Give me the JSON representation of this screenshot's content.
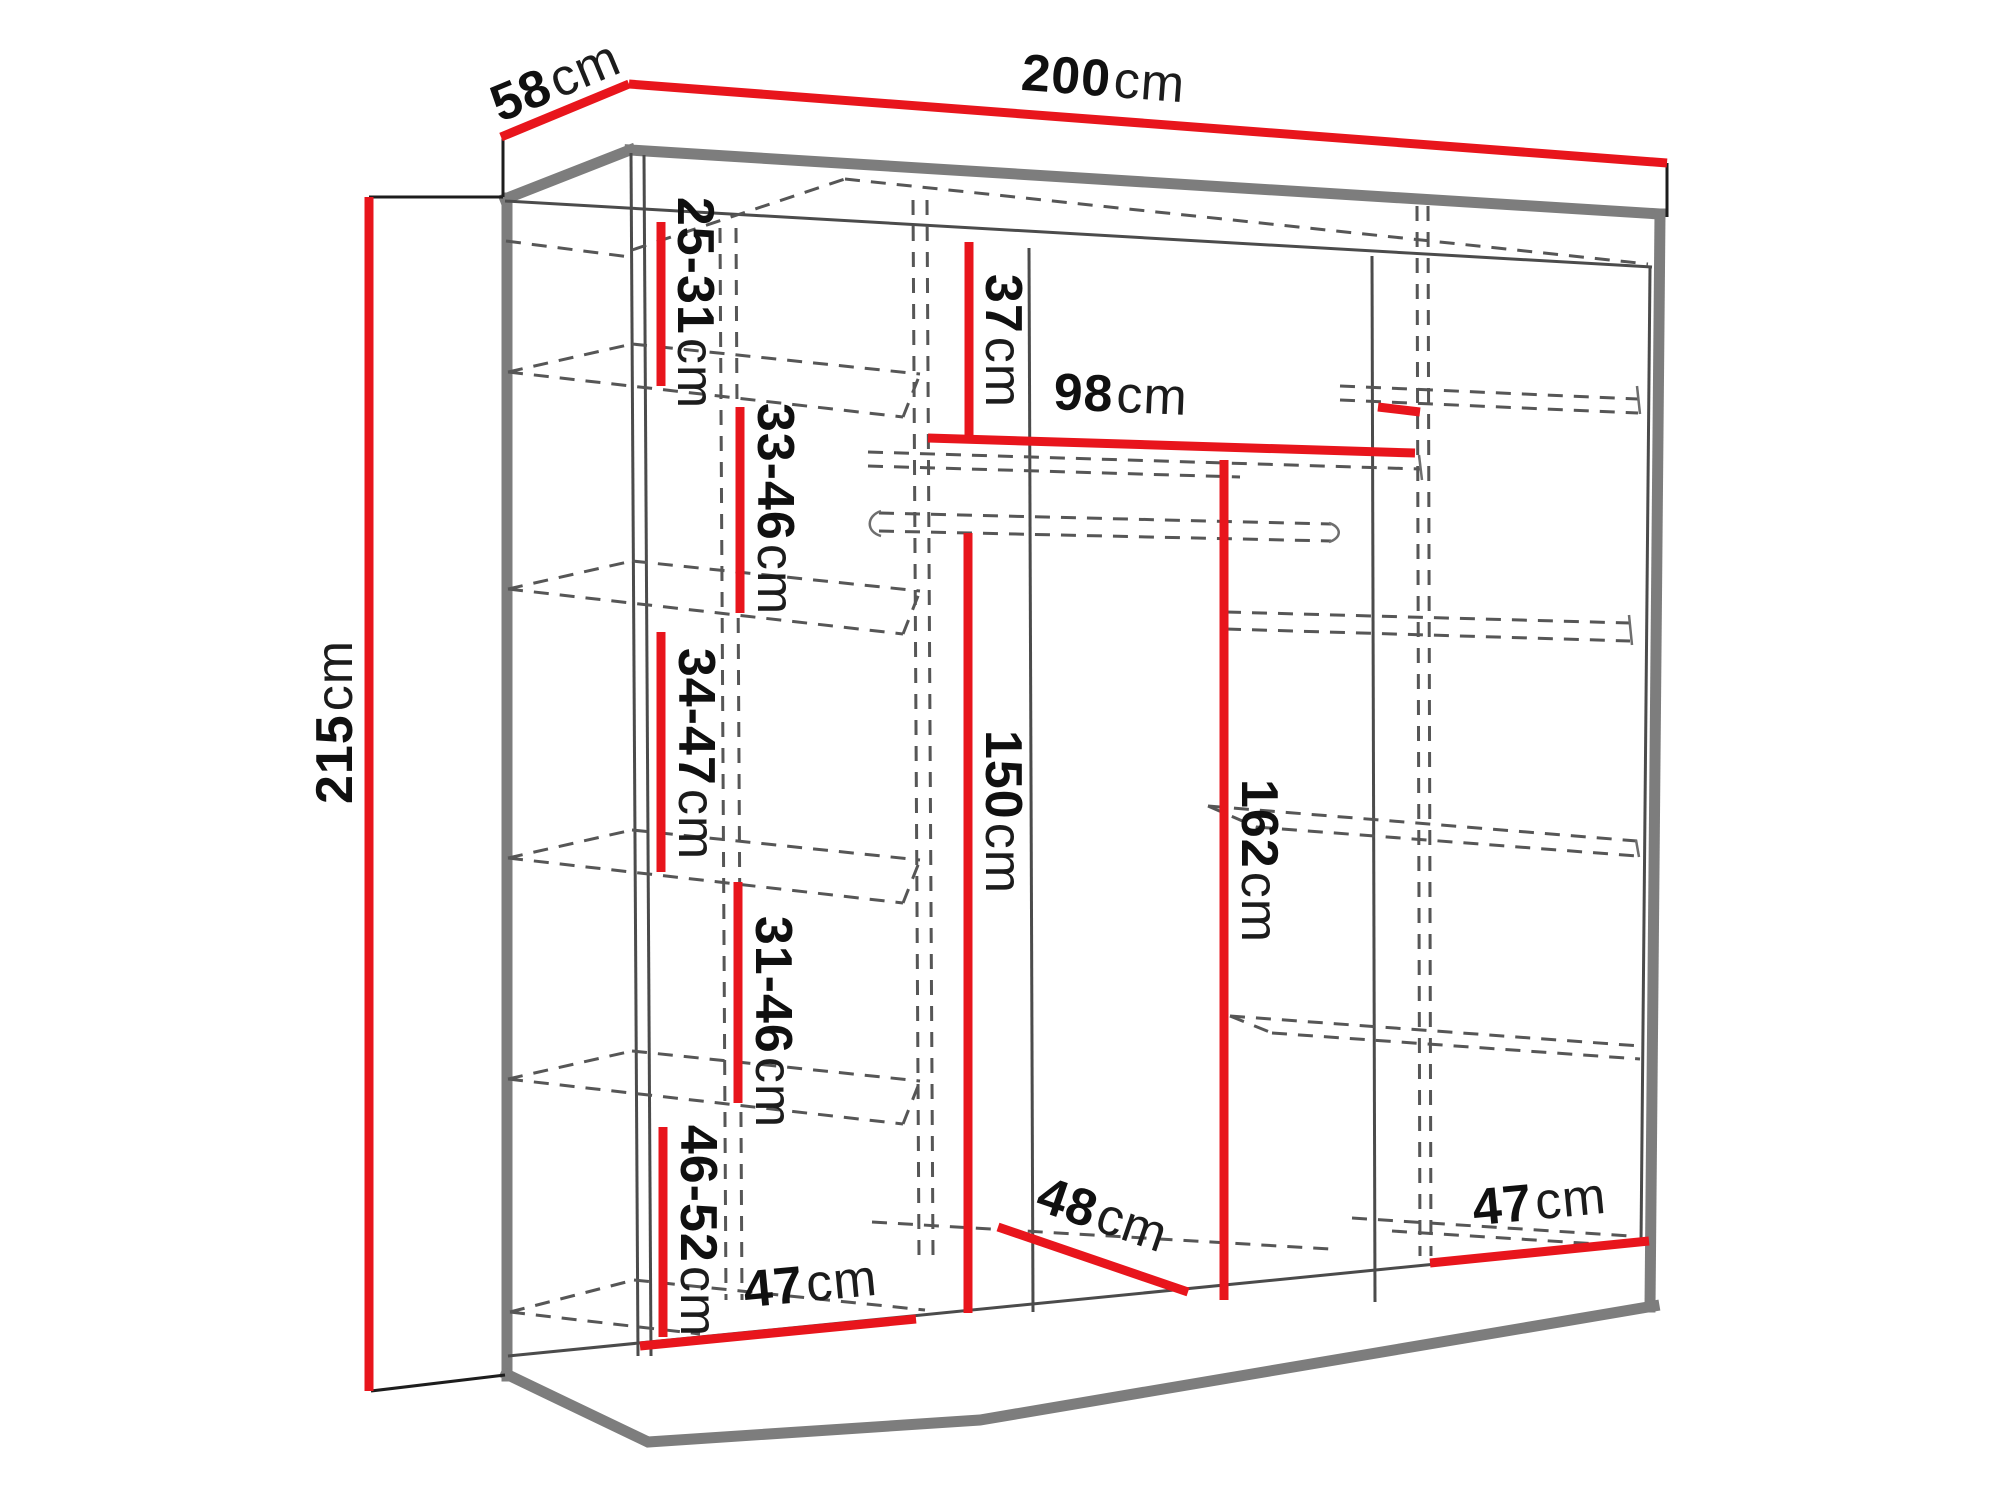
{
  "page": {
    "background": "#ffffff",
    "description_labels_only": "wardrobe dimension diagram"
  },
  "colors": {
    "dimension_red": "#e8151c",
    "structure_gray_thick": "#7d7d7d",
    "structure_gray_thin": "#4b4b4b",
    "dashed_gray": "#565656",
    "label_black": "#101010"
  },
  "diagram": {
    "unit": "cm",
    "labels": {
      "depth58": {
        "num": "58",
        "unit": "cm"
      },
      "width200": {
        "num": "200",
        "unit": "cm"
      },
      "height215": {
        "num": "215",
        "unit": "cm"
      },
      "gap2531": {
        "num": "25-31",
        "unit": "cm"
      },
      "gap3346": {
        "num": "33-46",
        "unit": "cm"
      },
      "gap3447": {
        "num": "34-47",
        "unit": "cm"
      },
      "gap3146": {
        "num": "31-46",
        "unit": "cm"
      },
      "gap4652": {
        "num": "46-52",
        "unit": "cm"
      },
      "top37": {
        "num": "37",
        "unit": "cm"
      },
      "shelf98": {
        "num": "98",
        "unit": "cm"
      },
      "hang150": {
        "num": "150",
        "unit": "cm"
      },
      "hang162": {
        "num": "162",
        "unit": "cm"
      },
      "depth48": {
        "num": "48",
        "unit": "cm"
      },
      "bottom47left": {
        "num": "47",
        "unit": "cm"
      },
      "bottom47right": {
        "num": "47",
        "unit": "cm"
      }
    },
    "dimensions_cm": {
      "overall": {
        "width": 200,
        "depth": 58,
        "height": 215
      },
      "interior": {
        "left_column_gaps": [
          "25-31",
          "33-46",
          "34-47",
          "31-46",
          "46-52"
        ],
        "top_gap": 37,
        "middle_shelf_width": 98,
        "hanging_heights": [
          150,
          162
        ],
        "floor_widths": [
          47,
          48,
          47
        ]
      }
    }
  }
}
